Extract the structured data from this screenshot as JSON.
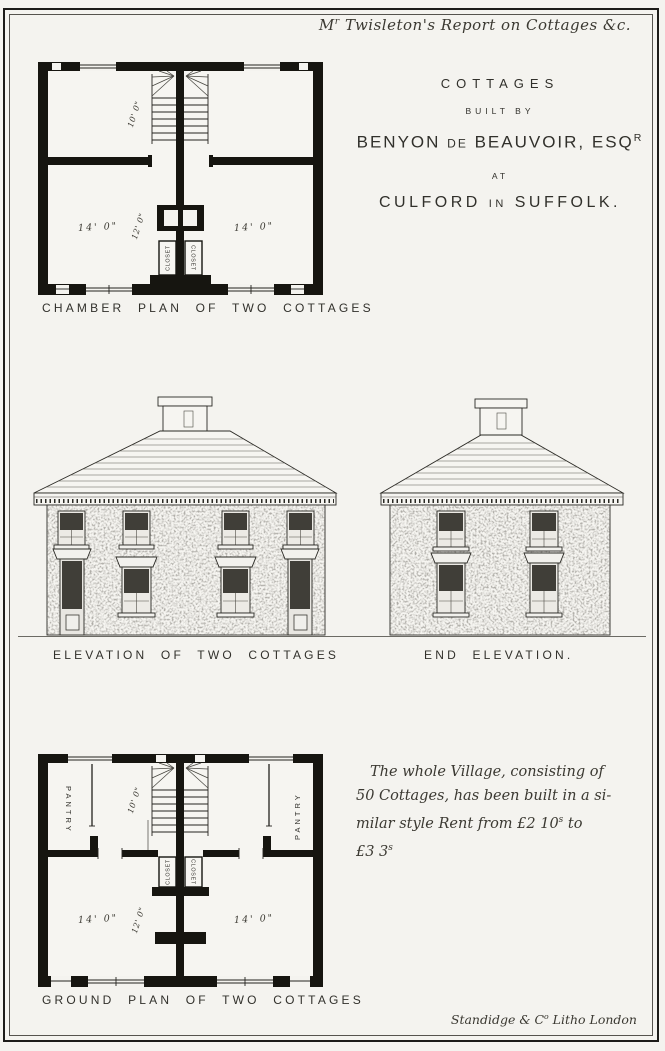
{
  "colors": {
    "paper": "#f4f3ef",
    "ink": "#1c1b19",
    "caption": "#31302b"
  },
  "header": {
    "prefix": "M",
    "prefix_sup": "r",
    "rest": " Twisleton's Report on Cottages &c."
  },
  "title_block": {
    "line1": "COTTAGES",
    "line2": "BUILT BY",
    "line3_a": "BENYON",
    "line3_mid": "DE",
    "line3_b": "BEAUVOIR, ESQ",
    "line3_sup": "R",
    "line4": "AT",
    "line5_a": "CULFORD",
    "line5_mid": "IN",
    "line5_b": "SUFFOLK."
  },
  "chamber_plan": {
    "caption": "CHAMBER PLAN OF TWO COTTAGES",
    "labels": {
      "stair_dim": "10' 0\"",
      "depth_dim": "12' 0\"",
      "left_room_dim": "14' 0\"",
      "right_room_dim": "14' 0\"",
      "closet_left": "CLOSET",
      "closet_right": "CLOSET"
    }
  },
  "elevations": {
    "front_caption": "ELEVATION OF TWO COTTAGES",
    "end_caption": "END ELEVATION."
  },
  "ground_plan": {
    "caption": "GROUND PLAN OF TWO COTTAGES",
    "labels": {
      "pantry_left": "PANTRY",
      "pantry_right": "PANTRY",
      "stair_dim": "10' 0\"",
      "depth_dim": "12' 0\"",
      "left_room_dim": "14' 0\"",
      "right_room_dim": "14' 0\"",
      "closet_left": "CLOSET",
      "closet_right": "CLOSET"
    }
  },
  "note": {
    "line1": "The whole Village, consisting of",
    "line2": "50 Cottages, has been built in a si-",
    "line3_a": "milar style   Rent from £2 10",
    "line3_sup": "s",
    "line3_b": " to",
    "line4_a": "£3 3",
    "line4_sup": "s"
  },
  "printer": {
    "main": "Standidge & C",
    "sup": "o",
    "rest": " Litho London"
  }
}
